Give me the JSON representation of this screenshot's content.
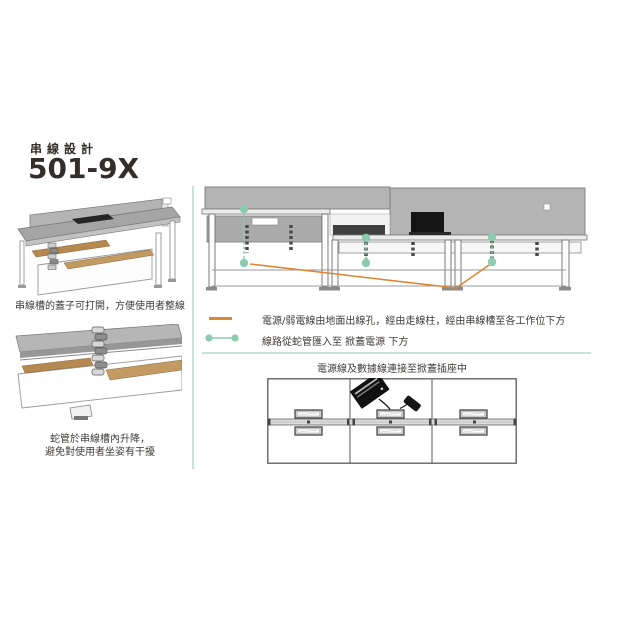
{
  "page": {
    "title_small": "串線設計",
    "model": "501-9X"
  },
  "left_column": {
    "figure1_caption": "串線槽的蓋子可打開，方便使用者整線",
    "figure2_caption_line1": "蛇管於串線槽內升降，",
    "figure2_caption_line2": "避免對使用者坐姿有干擾"
  },
  "legend": {
    "items": [
      {
        "swatch": "orange-cable-line",
        "label": "電源/弱電線由地面出線孔，經由走線柱，經由串線槽至各工作位下方"
      },
      {
        "swatch": "green-dotted-conduit-line",
        "label": "線路從蛇管匯入至 掀蓋電源 下方"
      }
    ]
  },
  "bottom_diagram": {
    "caption": "電源線及數據線連接至掀蓋插座中"
  },
  "colors": {
    "accent_orange": "#dd8733",
    "accent_green": "#8ccbb0",
    "divider_green": "#c6e5d6",
    "text_dark": "#332e2b",
    "screen_gray": "#b4b4b4",
    "wood_tan": "#b5894f",
    "laptop_black": "#141414"
  }
}
